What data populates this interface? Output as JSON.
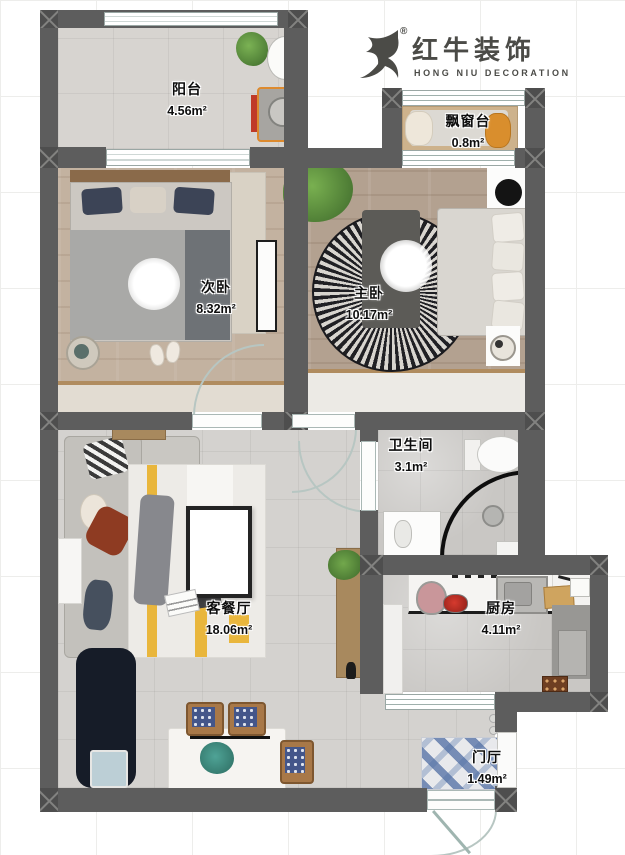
{
  "brand": {
    "icon": "bull-icon",
    "registered_mark": "®",
    "name_cn": "红牛装饰",
    "name_en": "HONG NIU DECORATION"
  },
  "rooms": {
    "balcony": {
      "label": "阳台",
      "area": "4.56m²"
    },
    "bay_window": {
      "label": "飘窗台",
      "area": "0.8m²"
    },
    "second_bedroom": {
      "label": "次卧",
      "area": "8.32m²"
    },
    "master_bedroom": {
      "label": "主卧",
      "area": "10.17m²"
    },
    "bathroom": {
      "label": "卫生间",
      "area": "3.1m²"
    },
    "living_dining": {
      "label": "客餐厅",
      "area": "18.06m²"
    },
    "kitchen": {
      "label": "厨房",
      "area": "4.11m²"
    },
    "entry": {
      "label": "门厅",
      "area": "1.49m²"
    }
  },
  "colors": {
    "wall": "#5d5d5d",
    "brand_gray": "#4b4b47",
    "accent_orange": "#d9862c",
    "door_arc": "#b7c6c2",
    "entry_mat_blue": "#4f6da3"
  }
}
